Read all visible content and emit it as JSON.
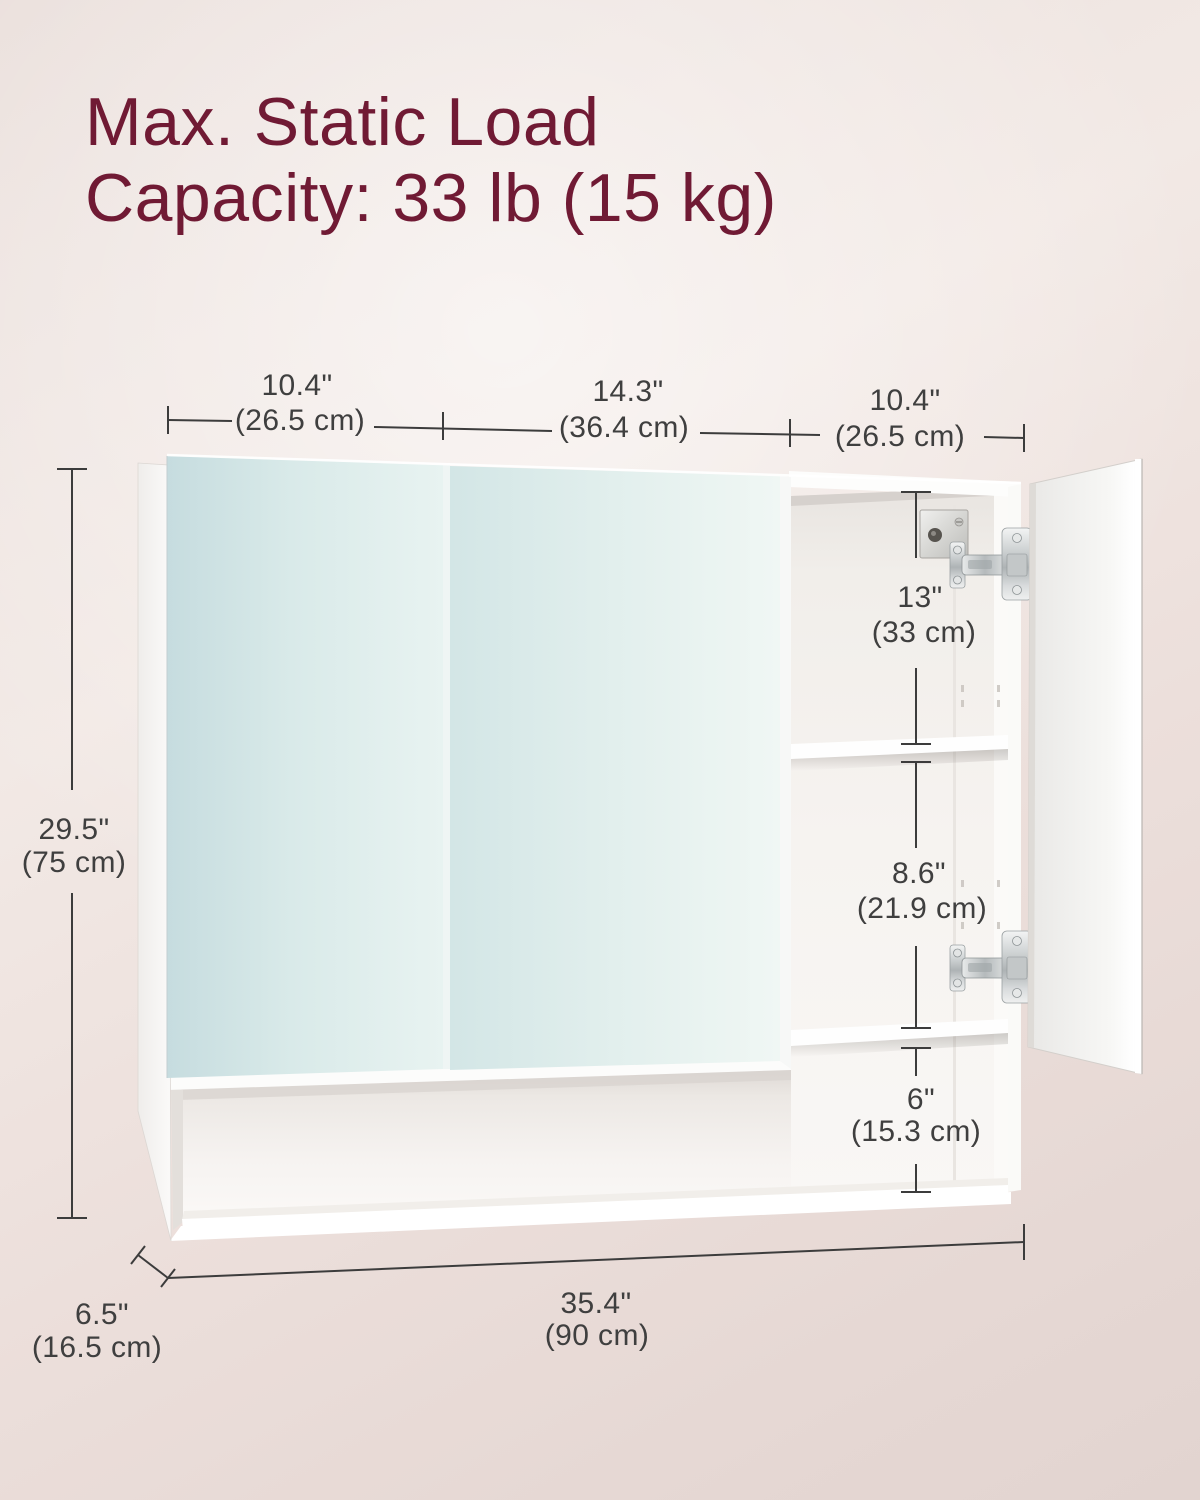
{
  "title": {
    "line1": "Max. Static Load",
    "line2": "Capacity: 33 lb (15 kg)"
  },
  "dimensions": {
    "top": [
      {
        "inch": "10.4\"",
        "cm": "(26.5 cm)"
      },
      {
        "inch": "14.3\"",
        "cm": "(36.4 cm)"
      },
      {
        "inch": "10.4\"",
        "cm": "(26.5 cm)"
      }
    ],
    "height": {
      "inch": "29.5\"",
      "cm": "(75 cm)"
    },
    "interior": [
      {
        "inch": "13\"",
        "cm": "(33 cm)"
      },
      {
        "inch": "8.6\"",
        "cm": "(21.9 cm)"
      },
      {
        "inch": "6\"",
        "cm": "(15.3 cm)"
      }
    ],
    "depth": {
      "inch": "6.5\"",
      "cm": "(16.5 cm)"
    },
    "width": {
      "inch": "35.4\"",
      "cm": "(90 cm)"
    }
  },
  "colors": {
    "accent_maroon": "#701a34",
    "dimension_line": "#3c3c3c",
    "dimension_text": "#3f3f3f",
    "mirror_tint": "#d8e9e9",
    "wall_background": "#ecdfdb",
    "cabinet_white": "#fcfcfb"
  },
  "icons": [
    "hinge-icon",
    "mounting-bracket-icon"
  ]
}
